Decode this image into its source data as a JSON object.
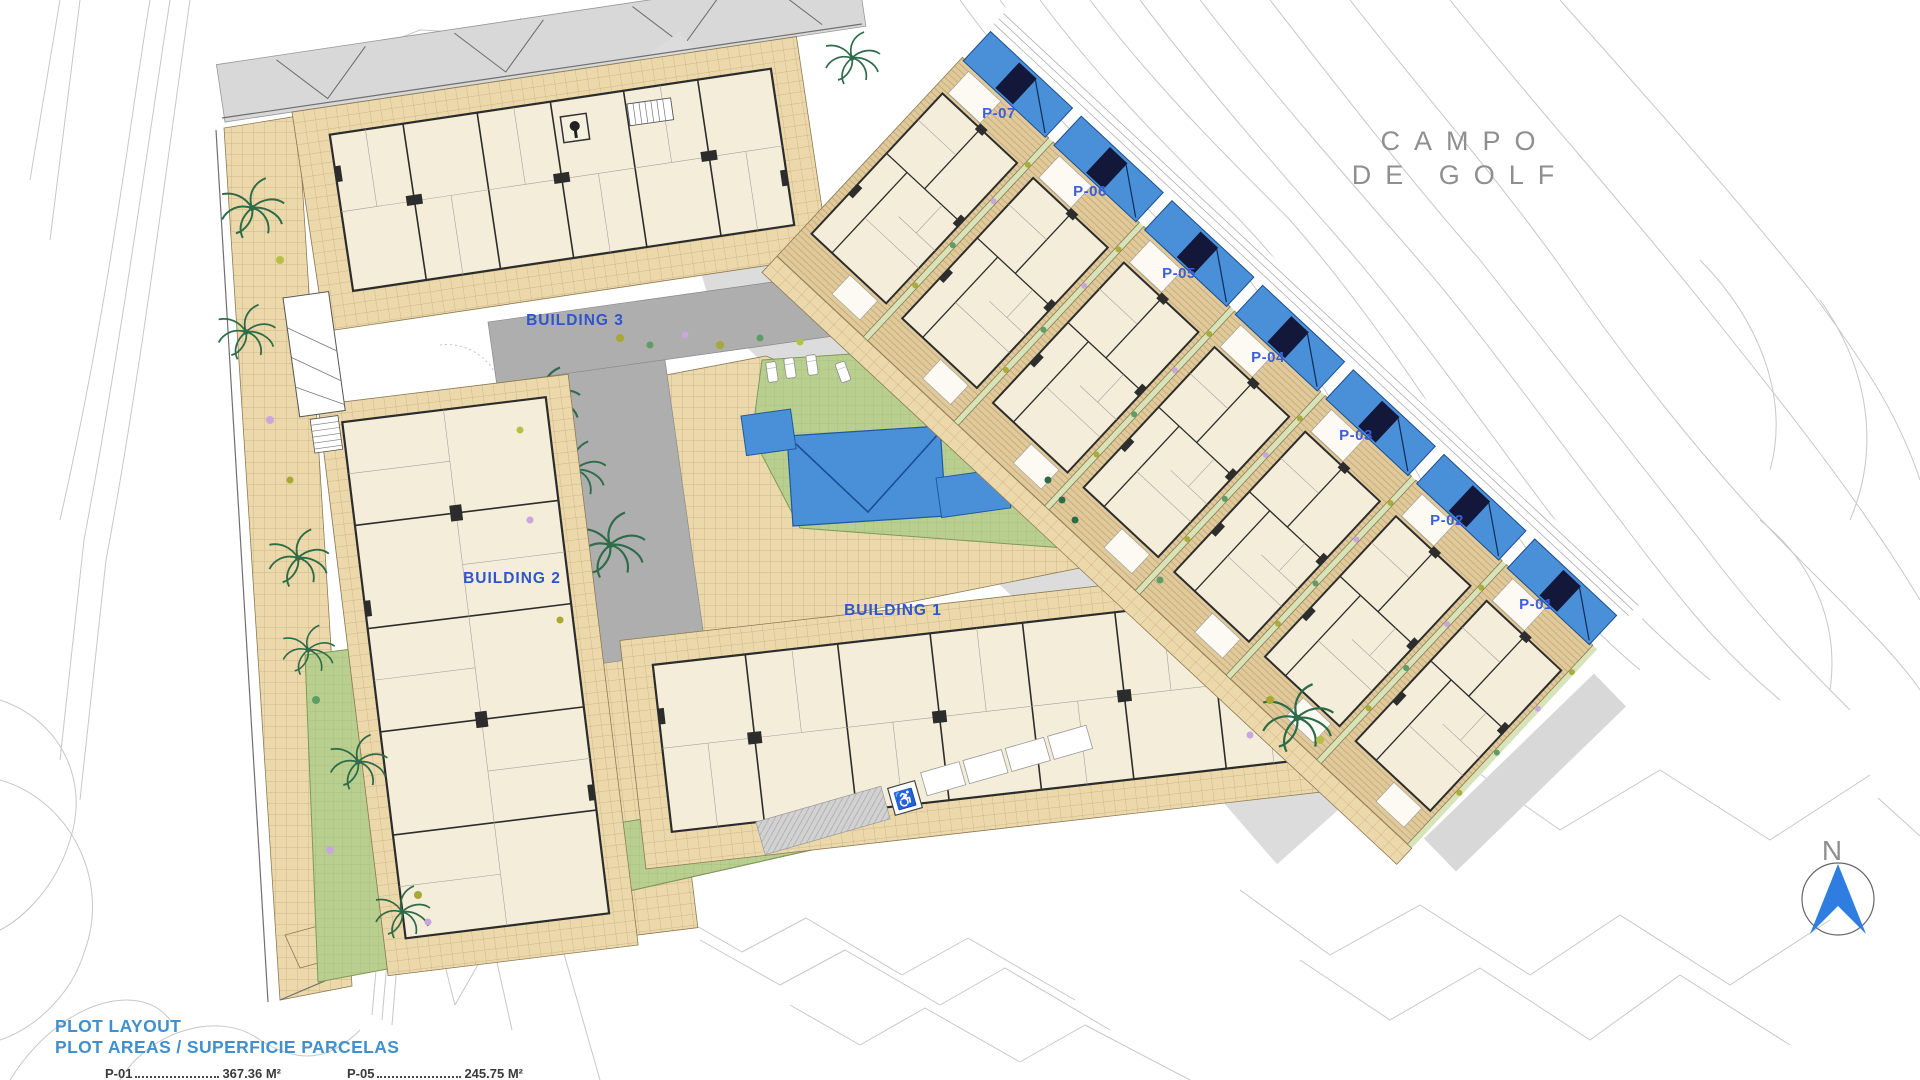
{
  "map": {
    "golf_label_line1": "CAMPO",
    "golf_label_line2": "DE GOLF",
    "north_label": "N",
    "buildings": [
      {
        "label": "BUILDING 3"
      },
      {
        "label": "BUILDING 2"
      },
      {
        "label": "BUILDING 1"
      }
    ],
    "villas": [
      {
        "label": "P-07"
      },
      {
        "label": "P-06"
      },
      {
        "label": "P-05"
      },
      {
        "label": "P-04"
      },
      {
        "label": "P-03"
      },
      {
        "label": "P-02"
      },
      {
        "label": "P-01"
      }
    ]
  },
  "legend": {
    "title": "PLOT LAYOUT",
    "subtitle": "PLOT AREAS / SUPERFICIE PARCELAS",
    "rows": [
      {
        "plot": "P-01",
        "area": "367.36 M²"
      },
      {
        "plot": "P-05",
        "area": "245.75 M²"
      }
    ]
  },
  "colors": {
    "pool_blue": "#4a90d9",
    "label_blue": "#2f55cc",
    "legend_blue": "#4090cf",
    "deck_tan": "#ecd9ab",
    "lawn_green": "#b9cf90",
    "road_gray": "#dcdcdc",
    "north_arrow_blue": "#2f7de1",
    "golf_text_gray": "#8f8f8f"
  }
}
